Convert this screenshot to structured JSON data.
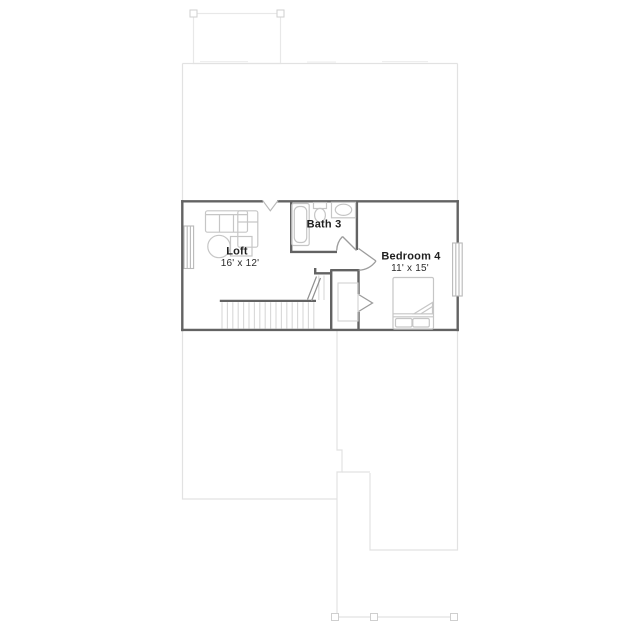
{
  "rooms": {
    "loft": {
      "name": "Loft",
      "dims": "16' x 12'"
    },
    "bath": {
      "name": "Bath 3"
    },
    "bedroom": {
      "name": "Bedroom 4",
      "dims": "11' x 15'"
    }
  },
  "colors": {
    "wall": "#636363",
    "fixture_outline": "#c6c6c6",
    "window_outline": "#b9b9b9",
    "door_swing": "#9c9c9c",
    "stair_tread": "#d8d8d8",
    "ghost_outline": "#e2e2e2",
    "label_text": "#1f1f1f",
    "background": "#ffffff"
  }
}
